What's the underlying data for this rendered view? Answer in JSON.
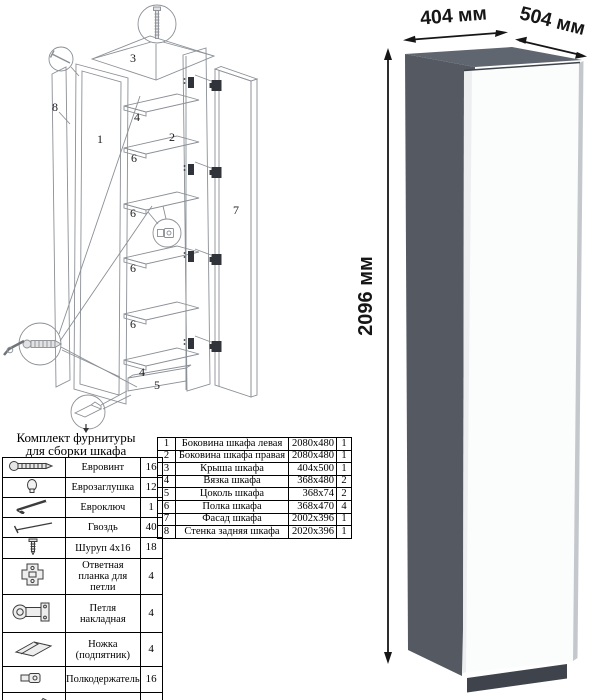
{
  "diagram": {
    "labels": [
      "1",
      "2",
      "3",
      "4",
      "5",
      "6",
      "7",
      "8"
    ]
  },
  "hardware_kit": {
    "title_line1": "Комплект фурнитуры",
    "title_line2": "для сборки шкафа",
    "items": [
      {
        "name": "Евровинт",
        "qty": "16",
        "icon": "euro-screw-icon"
      },
      {
        "name": "Еврозаглушка",
        "qty": "12",
        "icon": "euro-cap-icon"
      },
      {
        "name": "Евроключ",
        "qty": "1",
        "icon": "hex-key-icon"
      },
      {
        "name": "Гвоздь",
        "qty": "40",
        "icon": "nail-icon"
      },
      {
        "name": "Шуруп 4x16",
        "qty": "18",
        "icon": "screw-icon"
      },
      {
        "name": "Ответная планка для петли",
        "qty": "4",
        "icon": "hinge-plate-icon"
      },
      {
        "name": "Петля накладная",
        "qty": "4",
        "icon": "hinge-icon"
      },
      {
        "name": "Ножка (подпятник)",
        "qty": "4",
        "icon": "foot-icon"
      },
      {
        "name": "Полкодержатель",
        "qty": "16",
        "icon": "shelf-pin-icon"
      },
      {
        "name": "Толкатель (пуш)",
        "qty": "1",
        "icon": "push-rod-icon"
      }
    ]
  },
  "parts_table": {
    "rows": [
      {
        "num": "1",
        "name": "Боковина шкафа левая",
        "size": "2080x480",
        "qty": "1"
      },
      {
        "num": "2",
        "name": "Боковина шкафа правая",
        "size": "2080x480",
        "qty": "1"
      },
      {
        "num": "3",
        "name": "Крыша шкафа",
        "size": "404x500",
        "qty": "1"
      },
      {
        "num": "4",
        "name": "Вязка шкафа",
        "size": "368x480",
        "qty": "2"
      },
      {
        "num": "5",
        "name": "Цоколь шкафа",
        "size": "368x74",
        "qty": "2"
      },
      {
        "num": "6",
        "name": "Полка шкафа",
        "size": "368x470",
        "qty": "4"
      },
      {
        "num": "7",
        "name": "Фасад шкафа",
        "size": "2002x396",
        "qty": "1"
      },
      {
        "num": "8",
        "name": "Стенка задняя шкафа",
        "size": "2020x396",
        "qty": "1"
      }
    ]
  },
  "product": {
    "dim_width": "404 мм",
    "dim_depth": "504 мм",
    "dim_height": "2096 мм",
    "colors": {
      "top": "#606670",
      "side": "#545962",
      "front": "#fbfcfc",
      "front_shade": "#eceef0",
      "edge": "#c4c8cd",
      "plinth": "#3f444c",
      "dim": "#161616"
    }
  }
}
